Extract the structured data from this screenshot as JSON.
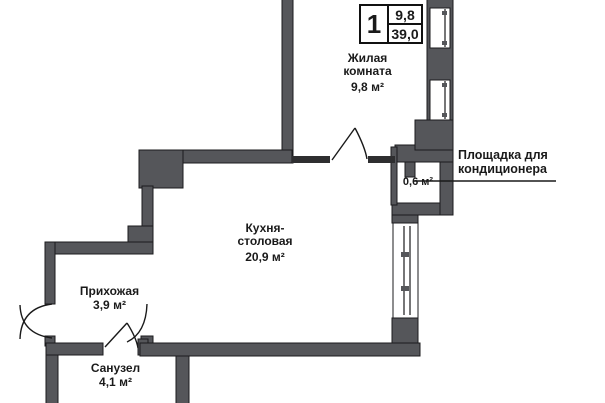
{
  "badge": {
    "rooms": "1",
    "living_area": "9,8",
    "total_area": "39,0"
  },
  "rooms": [
    {
      "id": "living",
      "name": "Жилая\nкомната",
      "area": "9,8 м²"
    },
    {
      "id": "kitchen",
      "name": "Кухня-\nстоловая",
      "area": "20,9 м²"
    },
    {
      "id": "hall",
      "name": "Прихожая",
      "area": "3,9 м²"
    },
    {
      "id": "bath",
      "name": "Санузел",
      "area": "4,1 м²"
    },
    {
      "id": "platform",
      "name": "",
      "area": "0,6 м²"
    }
  ],
  "annotation": {
    "platform_note": "Площадка для\nкондиционера"
  },
  "colors": {
    "wall": "#55565a",
    "partition": "#2e2e30",
    "line": "#1a1a1a",
    "background": "#ffffff"
  }
}
